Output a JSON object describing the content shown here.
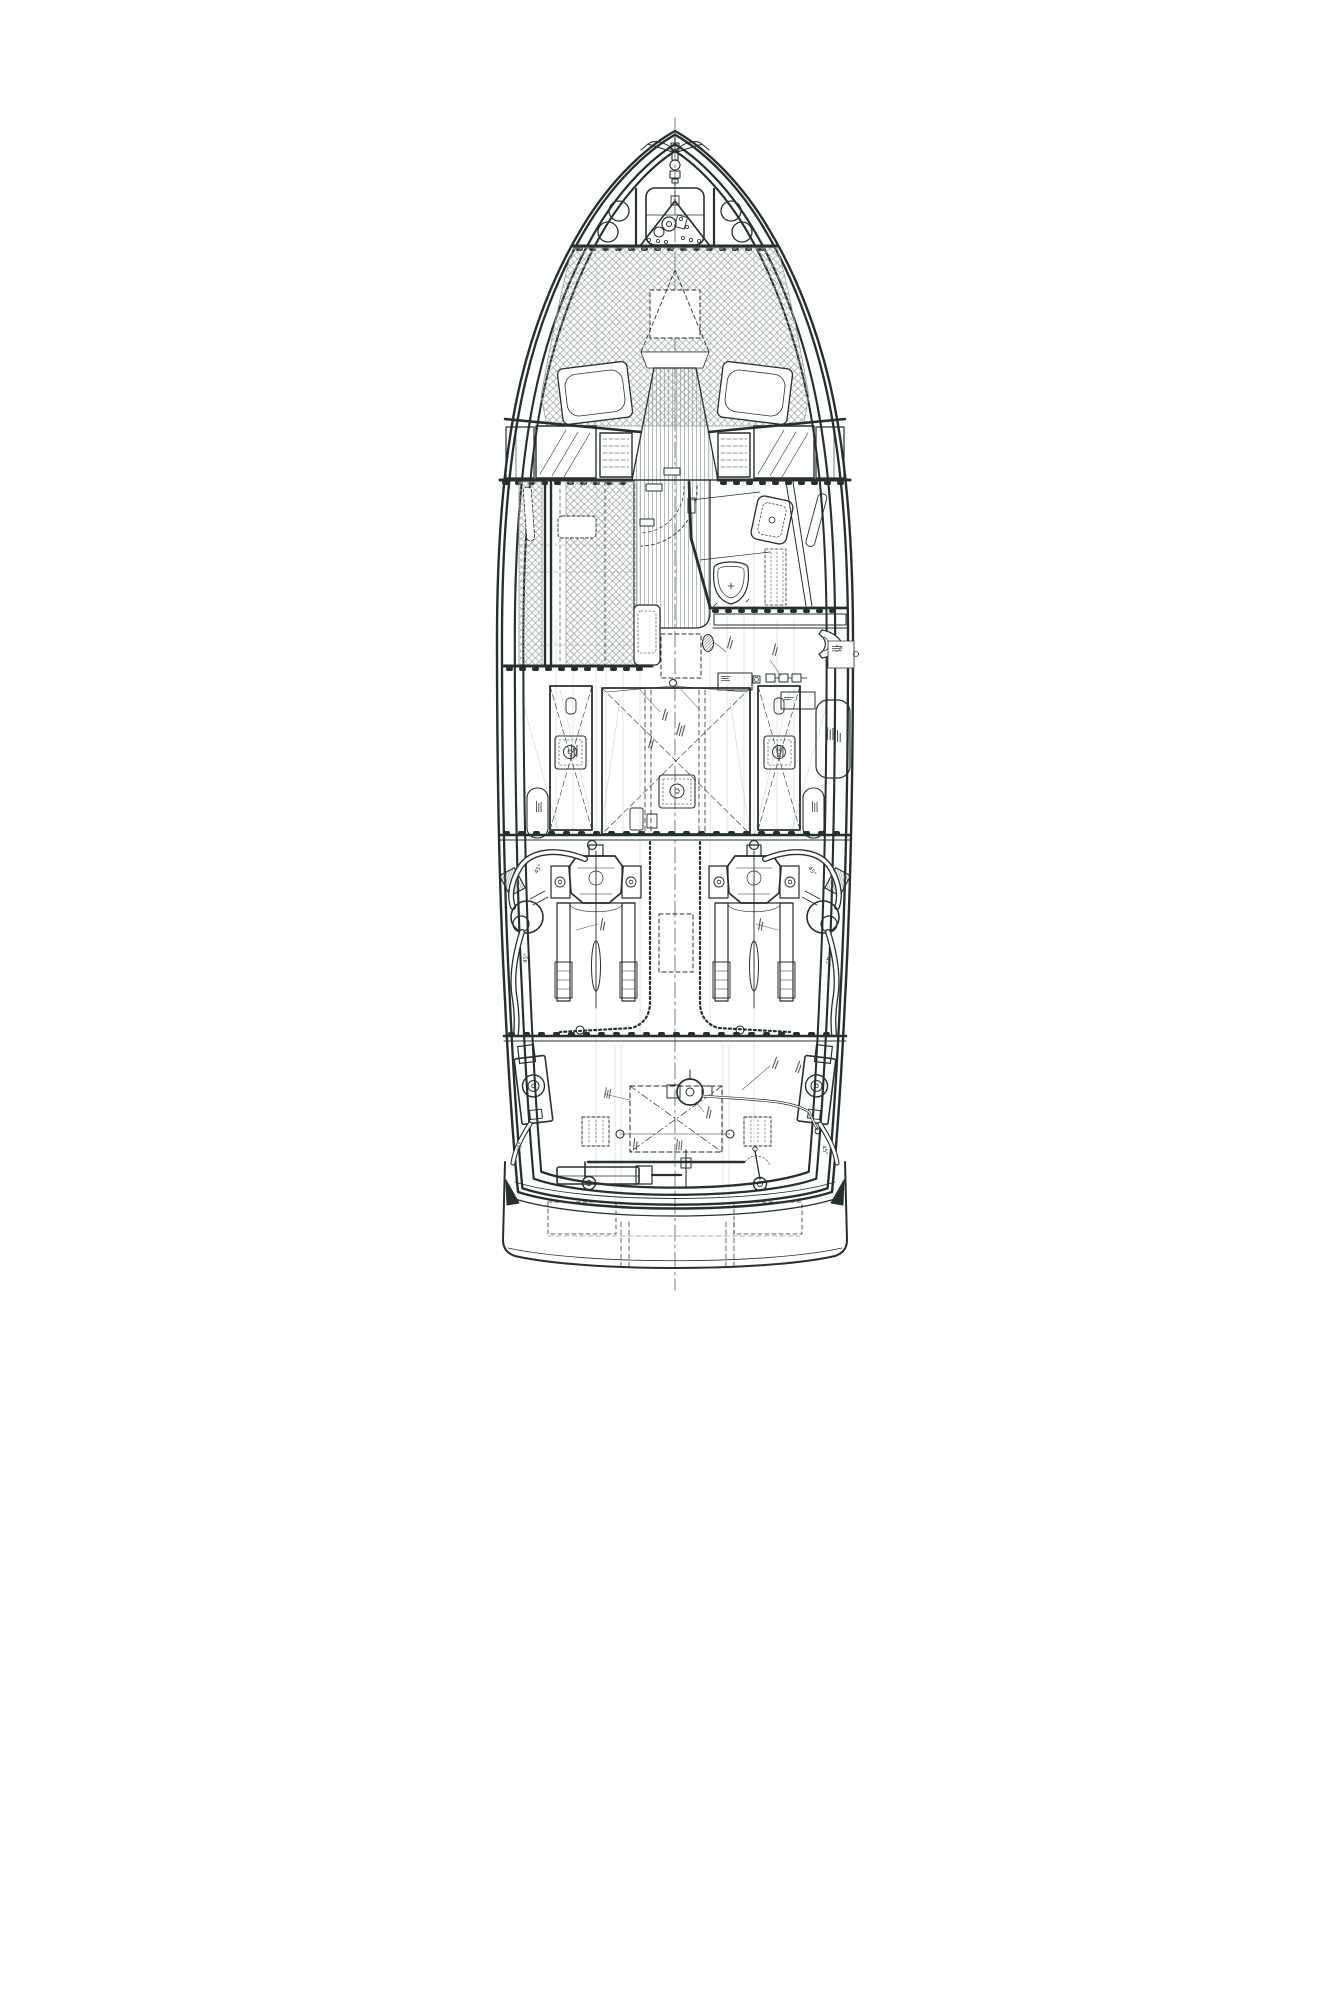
{
  "page": {
    "background": "#ffffff"
  },
  "drawing": {
    "subject": "motor-yacht deck and machinery arrangement plan",
    "view": "top view",
    "ink_color": "#26302c",
    "hatch_color": "#9aa39e",
    "construction_color": "#c6cdc9",
    "annotation_color": "#4f5a56"
  },
  "labels": {
    "angle45": "45°"
  },
  "annotations": {
    "legible_text": [
      "45°"
    ],
    "note": "numerous micro-scale equipment callouts, illegible at source resolution"
  },
  "component_inventory": [
    "anchor",
    "anchor-chain",
    "windlass",
    "bow-locker-hatch",
    "bow-rail-posts",
    "deck-hatches",
    "foredeck-sunpad",
    "foredeck-access-hatch",
    "sunpad-cushions",
    "center-walkway",
    "windshield",
    "side-windows",
    "salon-sunbeds",
    "companionway-door",
    "head-compartment",
    "toilet",
    "shower-tray",
    "galley-unit",
    "cockpit-bench",
    "water-tank-port",
    "fuel-tank-center",
    "water-tank-starboard",
    "tank-inspection-hatches",
    "boiler",
    "battery-charger",
    "battery-bank",
    "tender-icon",
    "side-lockers",
    "engine-port",
    "engine-starboard",
    "engine-beds",
    "propeller-shafts",
    "exhaust-mufflers",
    "exhaust-hoses",
    "engine-hatch-outline",
    "forward-bulkhead",
    "aft-bulkhead",
    "exhaust-transom-outlets",
    "steering-helm-fitting",
    "tie-bar",
    "hydraulic-steering-cylinder",
    "rudder-pivots",
    "lazarette-hatch",
    "transom",
    "swim-platform"
  ]
}
